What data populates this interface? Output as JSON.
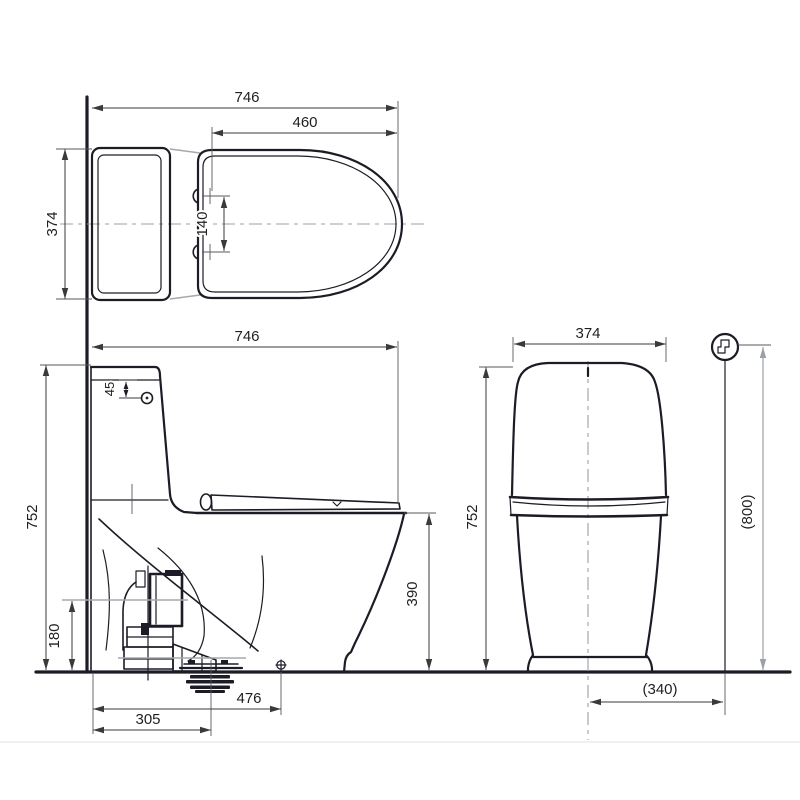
{
  "dims": {
    "top_overall_width": "746",
    "top_seat_length": "460",
    "top_depth": "374",
    "top_hinge_hole_spacing": "140",
    "side_overall_depth": "746",
    "side_lid_button_offset": "45",
    "side_overall_height": "752",
    "side_rim_height": "390",
    "side_trap_height": "180",
    "side_floor_bolt_offset": "476",
    "side_drain_offset": "305",
    "front_tank_width": "374",
    "front_overall_height": "752",
    "front_supply_height": "(800)",
    "front_supply_offset": "(340)"
  },
  "colors": {
    "line": "#1c1c26",
    "dimension": "#3a3a3a",
    "auxiliary_gray": "#a5a8ad",
    "centerline": "#9aa0a6",
    "background": "#ffffff"
  },
  "icons": {
    "water_supply": "water-supply-valve-icon"
  }
}
